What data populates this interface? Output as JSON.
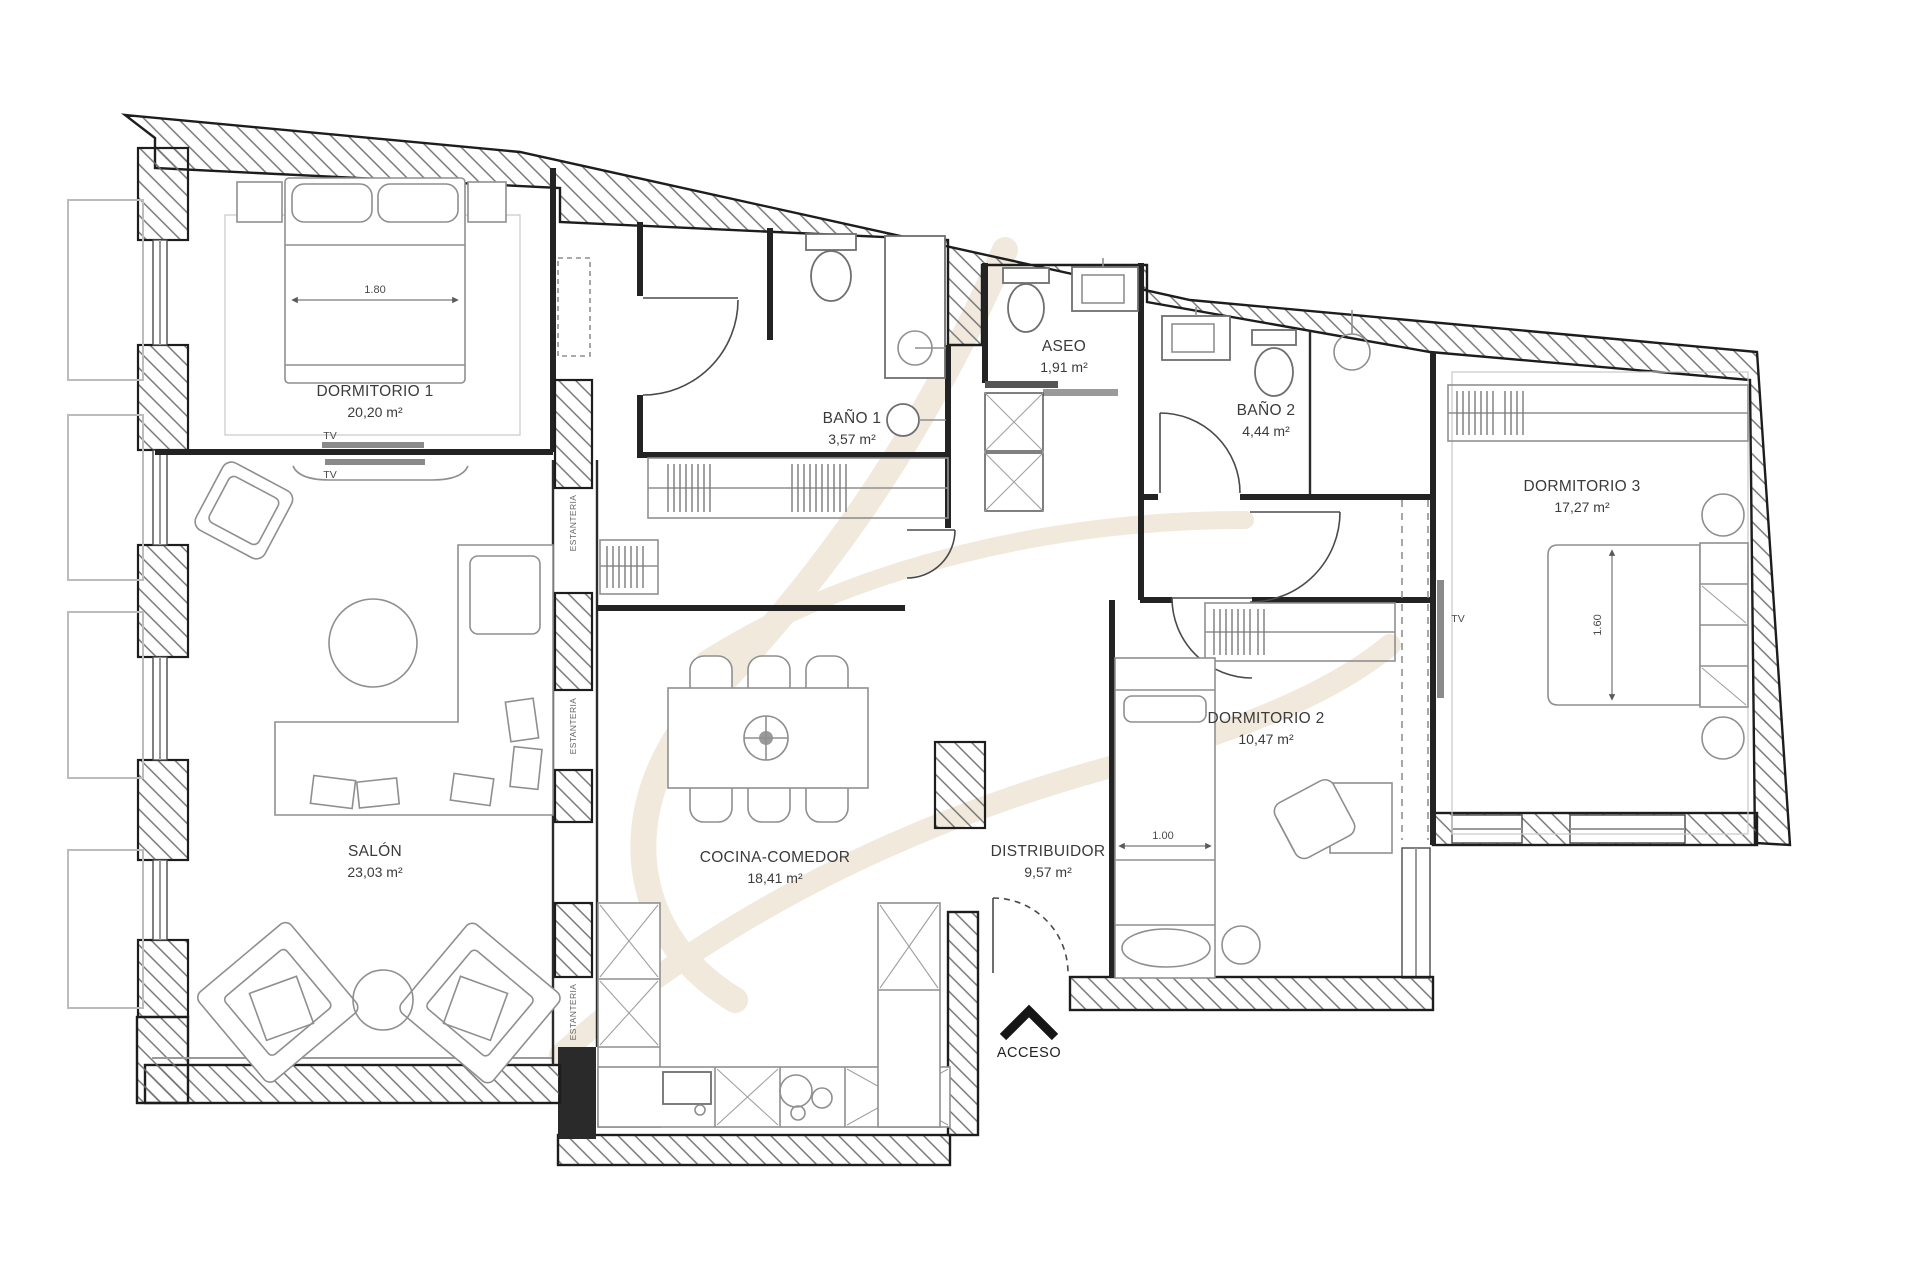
{
  "plan": {
    "rooms": [
      {
        "id": "dormitorio-1",
        "name": "DORMITORIO 1",
        "area": "20,20 m²"
      },
      {
        "id": "salon",
        "name": "SALÓN",
        "area": "23,03 m²"
      },
      {
        "id": "bano-1",
        "name": "BAÑO 1",
        "area": "3,57 m²"
      },
      {
        "id": "aseo",
        "name": "ASEO",
        "area": "1,91 m²"
      },
      {
        "id": "bano-2",
        "name": "BAÑO 2",
        "area": "4,44 m²"
      },
      {
        "id": "dormitorio-3",
        "name": "DORMITORIO 3",
        "area": "17,27 m²"
      },
      {
        "id": "cocina-comedor",
        "name": "COCINA-COMEDOR",
        "area": "18,41 m²"
      },
      {
        "id": "distribuidor",
        "name": "DISTRIBUIDOR",
        "area": "9,57 m²"
      },
      {
        "id": "dormitorio-2",
        "name": "DORMITORIO 2",
        "area": "10,47 m²"
      }
    ],
    "entrance_label": "ACCESO",
    "tv_label": "TV",
    "shelf_label": "ESTANTERIA",
    "dimensions": {
      "bed1": "1.80",
      "bed2": "1.00",
      "bed3": "1.60"
    },
    "colors": {
      "wall_line": "#1d1d1d",
      "hatch_line": "#6f6f6f",
      "furniture_line": "#8f8f8f",
      "balcony_line": "#bcbcbc",
      "label_text": "#3b3b3b",
      "watermark": "#ece2d1"
    }
  }
}
